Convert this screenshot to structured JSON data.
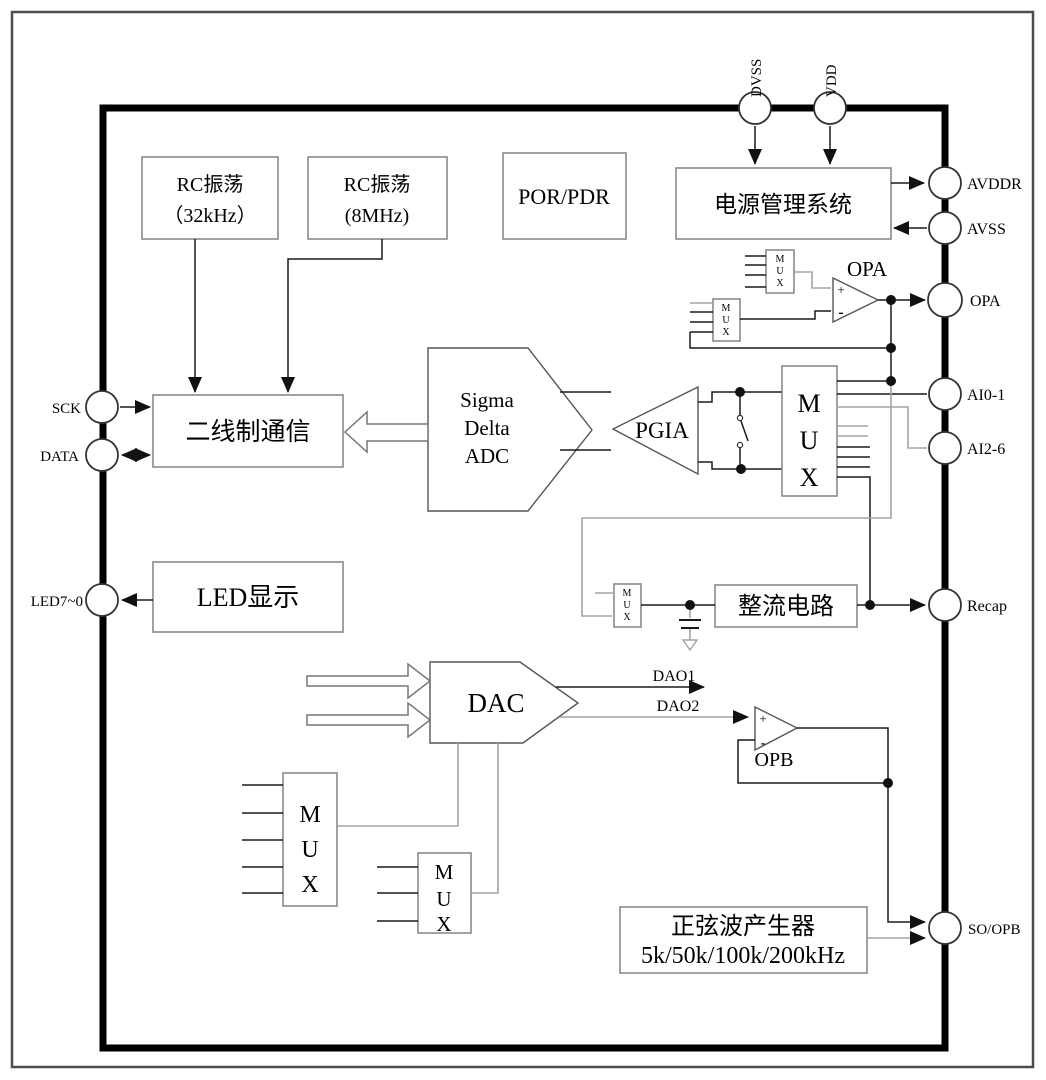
{
  "diagram": {
    "pins": {
      "dvss": "DVSS",
      "vdd": "VDD",
      "avddr": "AVDDR",
      "avss": "AVSS",
      "opa": "OPA",
      "ai0_1": "AI0-1",
      "ai2_6": "AI2-6",
      "recap": "Recap",
      "so_opb": "SO/OPB",
      "sck": "SCK",
      "data": "DATA",
      "led7_0": "LED7~0"
    },
    "blocks": {
      "rc32": {
        "line1": "RC振荡",
        "line2": "（32kHz）"
      },
      "rc8": {
        "line1": "RC振荡",
        "line2": "(8MHz)"
      },
      "por_pdr": "POR/PDR",
      "power_mgmt": "电源管理系统",
      "two_wire": "二线制通信",
      "adc": {
        "line1": "Sigma",
        "line2": "Delta",
        "line3": "ADC"
      },
      "pgia": "PGIA",
      "led_display": "LED显示",
      "rectifier": "整流电路",
      "dac": "DAC",
      "sine_gen": {
        "line1": "正弦波产生器",
        "line2": "5k/50k/100k/200kHz"
      },
      "opa_amp": "OPA",
      "opb_amp": "OPB",
      "mux": {
        "m": "M",
        "u": "U",
        "x": "X"
      },
      "plus": "+",
      "minus": "-"
    },
    "signals": {
      "dao1": "DAO1",
      "dao2": "DAO2"
    },
    "colors": {
      "wire": "#1a1a1a",
      "wire_gray": "#a3a3a3",
      "box_border": "#8a8a8a",
      "shape_border": "#555555",
      "text": "#000000",
      "bg": "#ffffff"
    }
  }
}
